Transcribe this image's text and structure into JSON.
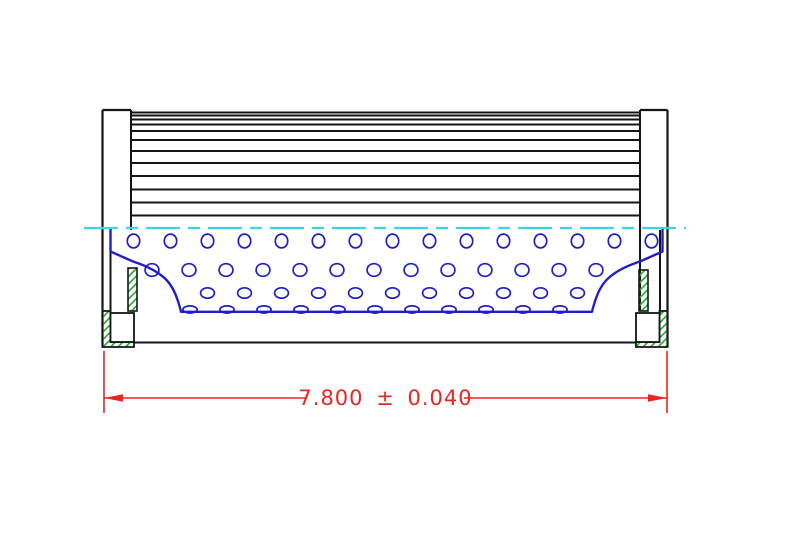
{
  "drawing": {
    "kind": "filter-element-cross-section"
  },
  "dimension": {
    "label": "7.800 ± 0.040"
  },
  "colors": {
    "outline": "#141414",
    "core_blue": "#1e1ecb",
    "centerline_cyan": "#3ed4e4",
    "hatch_green": "#2eb135",
    "dimension_red": "#ec2520",
    "background": "#ffffff"
  },
  "geometry": {
    "canvas": {
      "w": 789,
      "h": 546
    },
    "pleats": {
      "x1": 131,
      "x2": 640,
      "line_ys": [
        112.5,
        115.5,
        119.5,
        124.5,
        131,
        140,
        151,
        163,
        176,
        189.5,
        202.5,
        215.5
      ]
    },
    "left_cap": {
      "outer_x": 102.5,
      "top_y": 110,
      "bottom_y": 347,
      "inner_upper_x": 131,
      "inner_upper_y2": 230,
      "inner_lower_x": 110.5,
      "inner_lower_y1": 230,
      "inner_lower_y2": 313
    },
    "right_cap": {
      "outer_x": 667.5,
      "top_y": 110,
      "bottom_y": 347,
      "inner_upper_x": 640,
      "inner_upper_y2": 311,
      "inner_lower_x": 660,
      "inner_lower_y1": 230,
      "inner_lower_y2": 313
    },
    "centerline": {
      "y": 228,
      "x1": 84,
      "x2": 686,
      "dash": "34 8 12 8"
    },
    "core_outline_path": "M110.5,228.5 L110.5,251.5 L133,261.5 C147,266 159,272 167,280.5 C172.5,286.5 175.5,293.5 177.8,300.5 C179.2,305 180.3,308.5 181,311.8 L592,311.8 C592.7,308.5 593.8,305 595.2,300.5 C597.5,293.5 600.5,286.5 606,280.5 C614,272 626,266 640,261.5 L662.5,251.5 L662.5,228.5",
    "perforation_rows": [
      {
        "y": 241,
        "rx": 6.2,
        "ry": 6.9,
        "x0": 133.5,
        "dx": 37,
        "count": 15
      },
      {
        "y": 270,
        "rx": 6.9,
        "ry": 6.3,
        "x0": 152,
        "dx": 37,
        "count": 13
      },
      {
        "y": 293,
        "rx": 6.9,
        "ry": 5.2,
        "x0": 207.5,
        "dx": 37,
        "count": 11
      },
      {
        "y": 309.5,
        "rx": 7.1,
        "ry": 3.6,
        "x0": 190,
        "dx": 37,
        "count": 11
      }
    ],
    "gasket_left": {
      "hatch_path": "M102.5,311 H110.5 V342 H134 V347 H102.5 Z",
      "notch": {
        "x": 110.5,
        "y": 313,
        "w": 23.5,
        "h": 29
      },
      "strip": {
        "x": 128,
        "y": 268,
        "w": 9,
        "h": 43
      }
    },
    "gasket_right": {
      "hatch_path": "M667.5,311 H659.5 V342 H636 V347 H667.5 Z",
      "notch": {
        "x": 636,
        "y": 313,
        "w": 23.5,
        "h": 29
      },
      "strip": {
        "x": 639,
        "y": 270,
        "w": 9,
        "h": 41
      }
    },
    "bottom_edge": {
      "y": 342.5,
      "x1": 134,
      "x2": 636
    },
    "dimension_geom": {
      "ext_x1": 104,
      "ext_x2": 667,
      "ext_y1": 351,
      "ext_y2": 413,
      "line_y": 398,
      "gap_x1": 307,
      "gap_x2": 464,
      "arrow_len": 19,
      "arrow_half_w": 3.8,
      "text_x": 385.5,
      "text_y": 405
    }
  }
}
